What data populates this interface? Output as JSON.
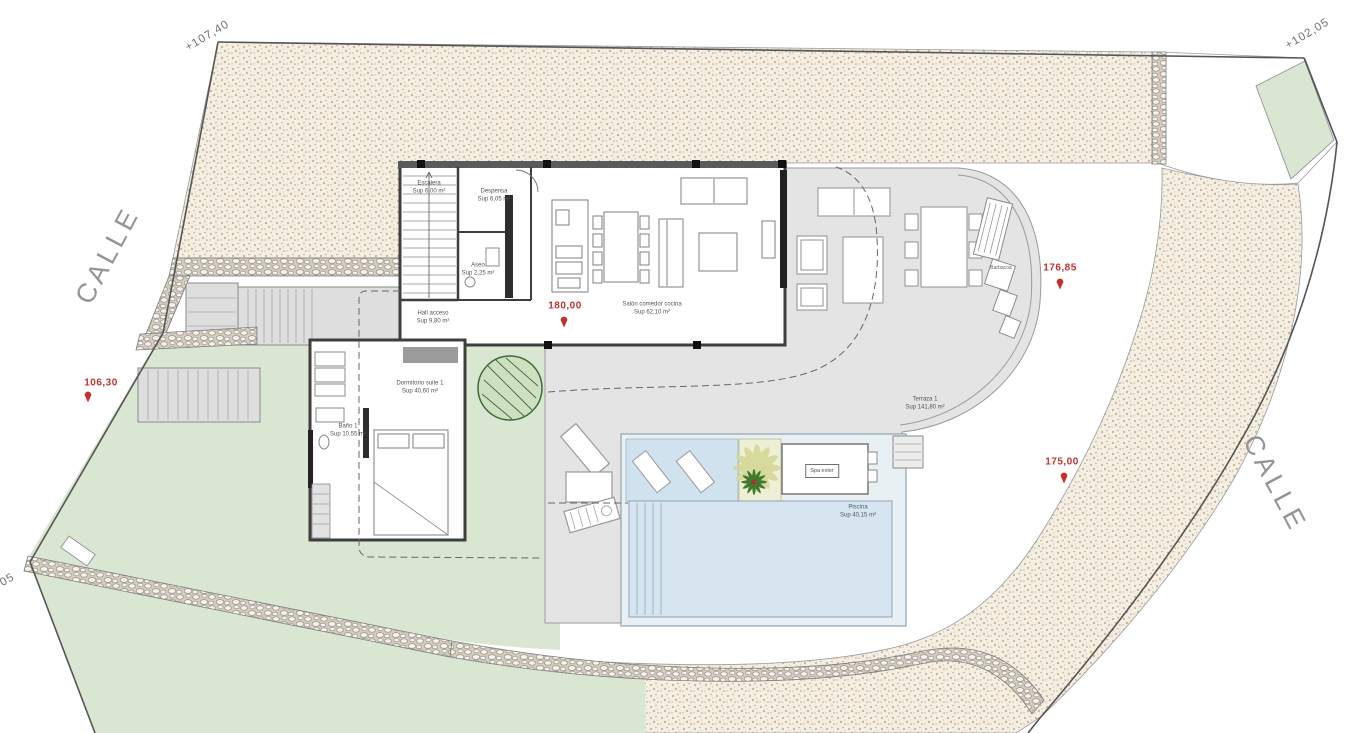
{
  "plan": {
    "streets": {
      "left": "CALLE",
      "right": "CALLE"
    },
    "levels": {
      "top_left": "+107,40",
      "top_right": "+102,05",
      "bottom_left": "05"
    },
    "markers": {
      "entry": "106,30",
      "floor": "180,00",
      "terrace": "176,85",
      "pool": "175,00"
    },
    "rooms": {
      "escalera": {
        "name": "Escalera",
        "area": "Sup 6,00 m²"
      },
      "despensa": {
        "name": "Despensa",
        "area": "Sup 6,05 m²"
      },
      "aseo": {
        "name": "Aseo",
        "area": "Sup 2,25 m²"
      },
      "hall": {
        "name": "Hall acceso",
        "area": "Sup 9,80 m²"
      },
      "salon": {
        "name": "Salón comedor cocina",
        "area": "Sup 62,10 m²"
      },
      "dormitorio": {
        "name": "Dormitorio suite 1",
        "area": "Sup 40,60 m²"
      },
      "bano": {
        "name": "Baño 1",
        "area": "Sup 10,55 m²"
      },
      "terraza": {
        "name": "Terraza 1",
        "area": "Sup 141,80 m²"
      },
      "piscina": {
        "name": "Piscina",
        "area": "Sup 40,15 m²"
      },
      "spa": {
        "name": "Spa exter"
      },
      "barbacoa": {
        "name": "Barbacoa"
      }
    },
    "colors": {
      "accent_red": "#bf3330",
      "gravel_bg": "#f4eee3",
      "green": "#d9e6d2",
      "terrace_gray": "#e4e4e4",
      "pool_water": "#d6e5ef",
      "wall_dark": "#3e3e3e"
    }
  }
}
